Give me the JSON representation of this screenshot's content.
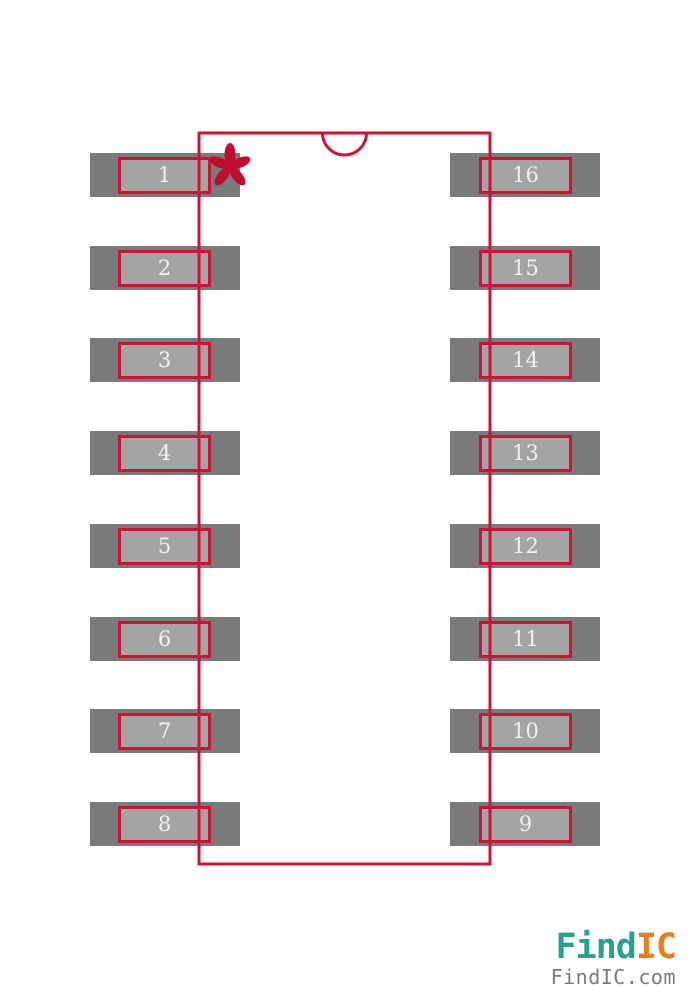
{
  "document": {
    "background_color": "#ffffff",
    "content_type": "IC footprint land pattern preview, 16-pin dual-row package"
  },
  "footprint": {
    "outline_color": "#cd1335",
    "pad_outer_color": "#7a7a7a",
    "pad_inner_color": "#a4a4a4",
    "pad_border_color": "#cd1335",
    "pin_number_color": "#f0f0f0",
    "pin1_marker": {
      "shape": "asterisk",
      "color": "#c00d2e"
    },
    "pins": {
      "left": [
        "1",
        "2",
        "3",
        "4",
        "5",
        "6",
        "7",
        "8"
      ],
      "right": [
        "16",
        "15",
        "14",
        "13",
        "12",
        "11",
        "10",
        "9"
      ]
    }
  },
  "branding": {
    "logo_part1": "Find",
    "logo_part2": "IC",
    "logo_color1": "#2aa093",
    "logo_color2": "#ee7d1d",
    "site_text": "FindIC.com",
    "site_color": "#7b7b7b"
  }
}
